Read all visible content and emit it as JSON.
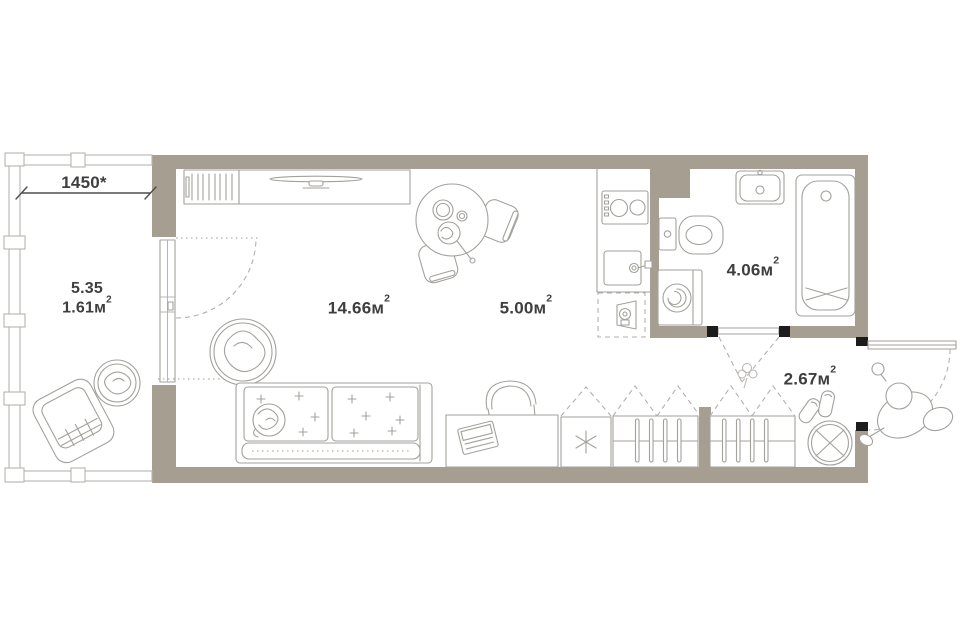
{
  "dimension": {
    "label": "1450*"
  },
  "balcony": {
    "area": "5.35",
    "reduced_area": "1.61м",
    "sup": "2"
  },
  "rooms": [
    {
      "id": "living-room",
      "area": "14.66м",
      "sup": "2"
    },
    {
      "id": "kitchen",
      "area": "5.00м",
      "sup": "2"
    },
    {
      "id": "bathroom",
      "area": "4.06м",
      "sup": "2"
    },
    {
      "id": "hallway",
      "area": "2.67м",
      "sup": "2"
    }
  ],
  "colors": {
    "wall": "#a69f91",
    "line": "#a3a19c",
    "line-light": "#b6b4af",
    "dash": "#b3b1ac",
    "text": "#3e3e3e",
    "stop": "#1c1c1c",
    "bg": "#ffffff"
  },
  "icons": [
    "radiator",
    "tv-console",
    "tv",
    "dining-table",
    "dining-chair",
    "swivel-chair",
    "double-bed",
    "cat",
    "desk",
    "office-chair",
    "laptop",
    "fridge",
    "wardrobe-hangers",
    "stove",
    "kitchen-sink",
    "dishwasher",
    "bathroom-sink",
    "toilet",
    "washing-machine",
    "bathtub",
    "pouf",
    "shoes",
    "flower",
    "person",
    "armchair",
    "balcony-pouf",
    "door-swing",
    "window",
    "dimension-line"
  ]
}
